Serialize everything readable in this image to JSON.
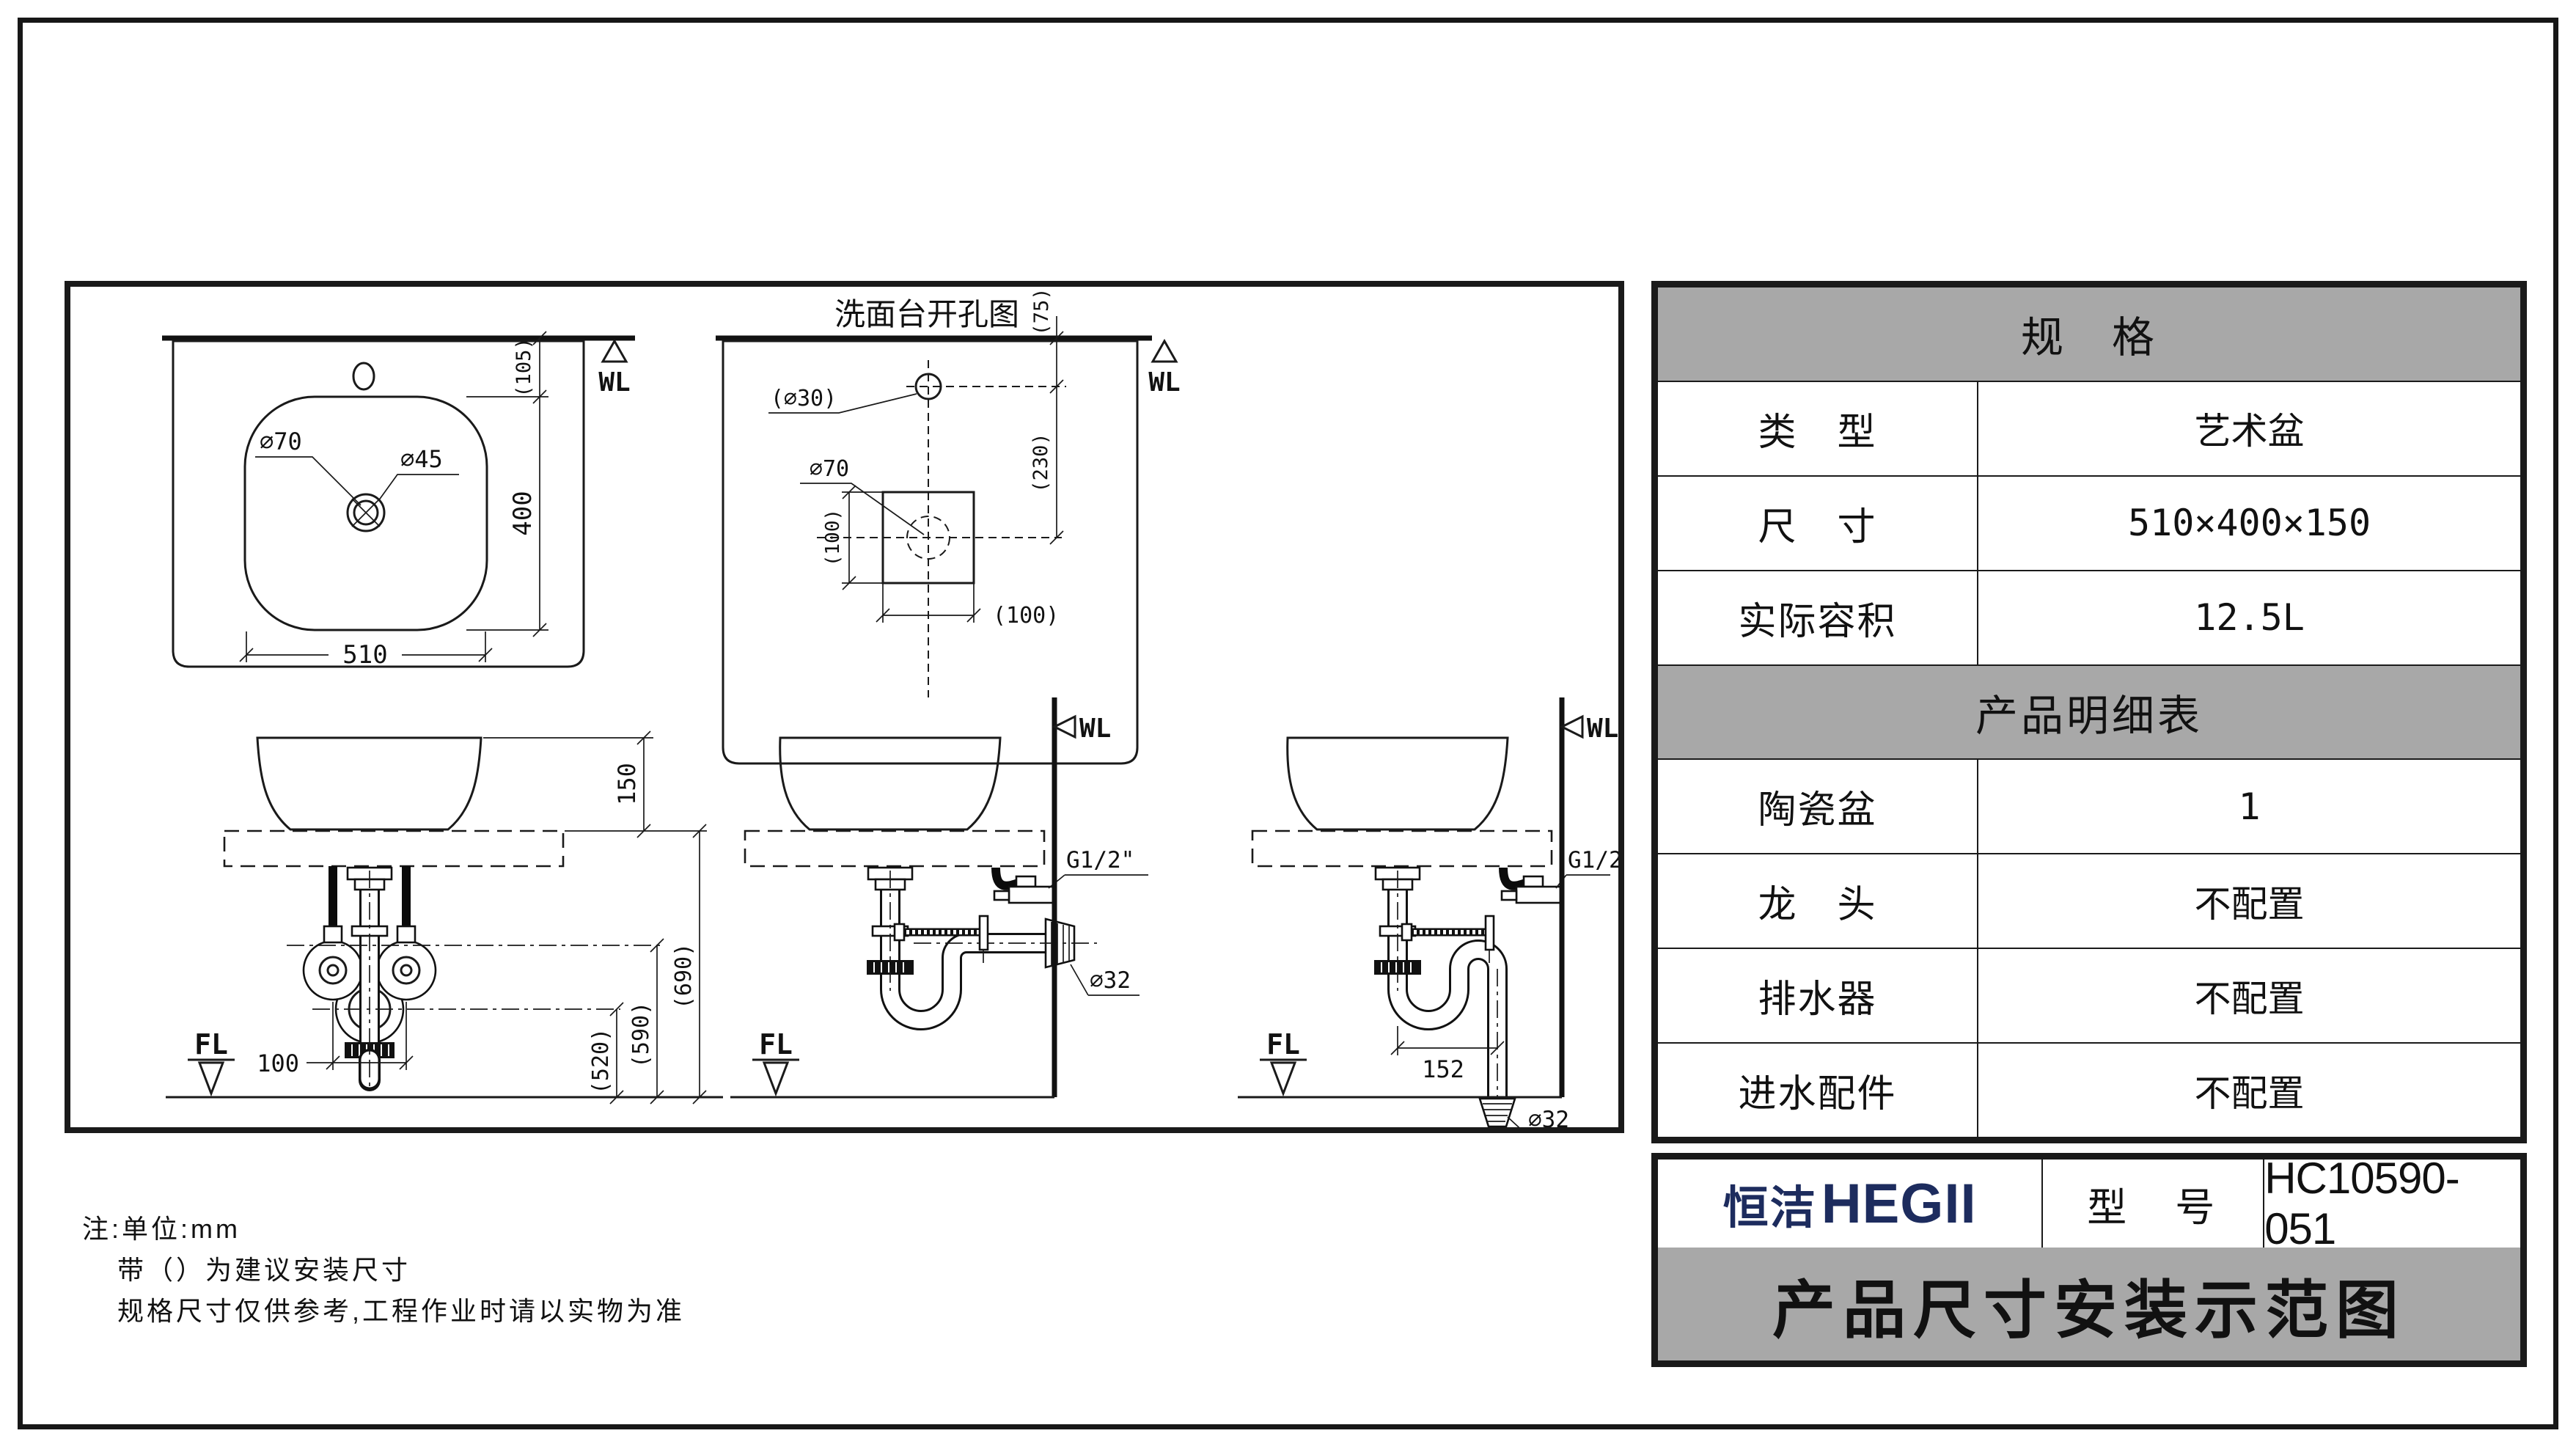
{
  "colors": {
    "header_gray": "#a8a8a8",
    "brand_navy": "#1d2c5e",
    "line_black": "#1a1a1a"
  },
  "drawings": {
    "top_view": {
      "wl": "WL",
      "d70": "∅70",
      "d45": "∅45",
      "width": "510",
      "depth": "400",
      "offset": "(105)"
    },
    "cutout": {
      "title": "洗面台开孔图",
      "wl": "WL",
      "hole": "(∅30)",
      "d70": "∅70",
      "off75": "(75)",
      "off230": "(230)",
      "v100": "(100)",
      "h100": "(100)"
    },
    "front": {
      "h150": "150",
      "h690": "(690)",
      "h590": "(590)",
      "h520": "(520)",
      "w100": "100",
      "fl": "FL"
    },
    "wall_drain": {
      "wl": "WL",
      "g": "G1/2\"",
      "d32": "∅32",
      "fl": "FL"
    },
    "floor_drain": {
      "wl": "WL",
      "g": "G1/2\"",
      "d32": "∅32",
      "w152": "152",
      "fl": "FL"
    }
  },
  "spec_table": {
    "section1": "规　格",
    "rows1": [
      {
        "label": "类　型",
        "value": "艺术盆"
      },
      {
        "label": "尺　寸",
        "value": "510×400×150"
      },
      {
        "label": "实际容积",
        "value": "12.5L"
      }
    ],
    "section2": "产品明细表",
    "rows2": [
      {
        "label": "陶瓷盆",
        "value": "1"
      },
      {
        "label": "龙　头",
        "value": "不配置"
      },
      {
        "label": "排水器",
        "value": "不配置"
      },
      {
        "label": "进水配件",
        "value": "不配置"
      }
    ]
  },
  "title_block": {
    "brand_cn": "恒洁",
    "brand_en": "HEGII",
    "model_label": "型　号",
    "model_value": "HC10590-051",
    "banner": "产品尺寸安装示范图"
  },
  "notes": {
    "line1": "注:单位:mm",
    "line2": "带（）为建议安装尺寸",
    "line3": "规格尺寸仅供参考,工程作业时请以实物为准"
  }
}
